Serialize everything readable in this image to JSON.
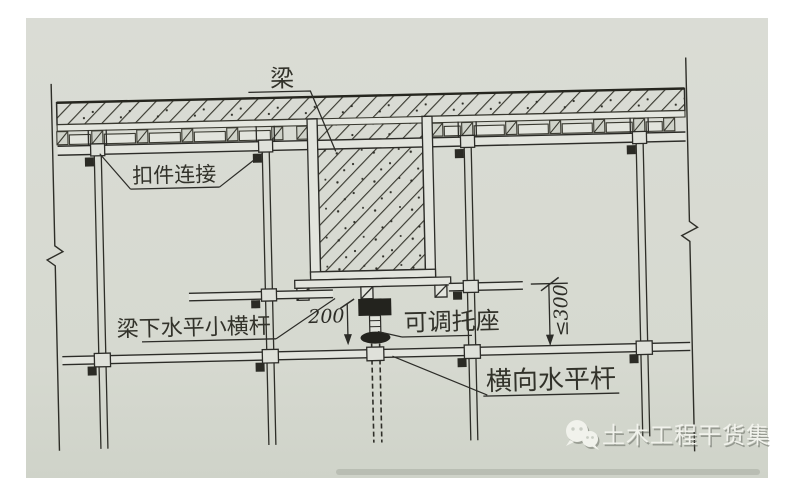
{
  "figure": {
    "labels": {
      "beam": "梁",
      "coupler_connection": "扣件连接",
      "beam_bottom_bar": "梁下水平小横杆",
      "adjustable_bracket": "可调托座",
      "transverse_bar": "横向水平杆"
    },
    "dimensions": {
      "beam_offset": "200",
      "clearance": "≤300"
    },
    "watermark": {
      "icon": "wechat-icon",
      "text": "土木工程干货集"
    },
    "colors": {
      "paper": "#d7dad2",
      "ink": "#2c2c28",
      "watermark_text": "#f1f2ec"
    }
  }
}
